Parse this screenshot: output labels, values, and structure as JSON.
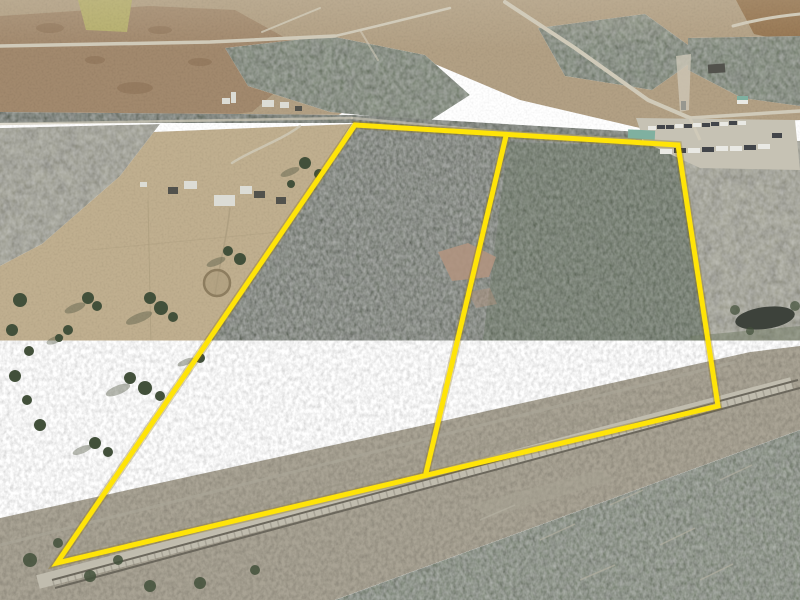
{
  "meta": {
    "description": "Aerial drone photograph of a forested land parcel outlined in yellow, split into two lots by an interior yellow line, bordered by a railroad corridor at the bottom, pasture and farm buildings at left, roads and a truck parking lot at top right, and a small pond at right"
  },
  "boundary": {
    "color": "#ffe408",
    "outline_color": "#8f7200",
    "stroke_width": 5,
    "shadow_width": 8,
    "outer_points": "355,125 678,145 718,406 57,563",
    "divider_points": "506,136 426,473"
  },
  "scene": {
    "colors": {
      "field_tan": "#b2a084",
      "field_brown": "#97795d",
      "field_green": "#b6af6c",
      "dirt_red": "#95744f",
      "pasture": "#c0af8f",
      "pine_dark": "#42503a",
      "pine_mid": "#55664a",
      "forest_gray": "#91917f",
      "woods_left": "#6d7860",
      "scrub": "#a9a394",
      "gravel": "#c0bcae",
      "rail_dark": "#6b675c",
      "road_light": "#d0cab9",
      "pond": "#3d423b",
      "shadow": "#4f5540",
      "clearing": "#b0937f",
      "truck_white": "#e9e9e4",
      "truck_dark": "#42454a",
      "teal_roof": "#7fb0a0",
      "barn_white": "#dcdcd5",
      "barn_dark": "#52524c",
      "pen_ring": "#8d7d5f",
      "log_gray": "#b5b1a2",
      "wet_patch": "#8a6f54",
      "trail": "#ab9c7e"
    },
    "features": [
      "parcel-boundary-outline",
      "parcel-divider-line",
      "pine-forest-parcel",
      "interior-clearing",
      "pasture-field",
      "farm-buildings",
      "round-pen",
      "railroad-corridor",
      "railroad-tracks",
      "truck-parking-lot",
      "pond",
      "tower-clearing",
      "roads",
      "bottom-forest",
      "scattered-trees"
    ]
  }
}
